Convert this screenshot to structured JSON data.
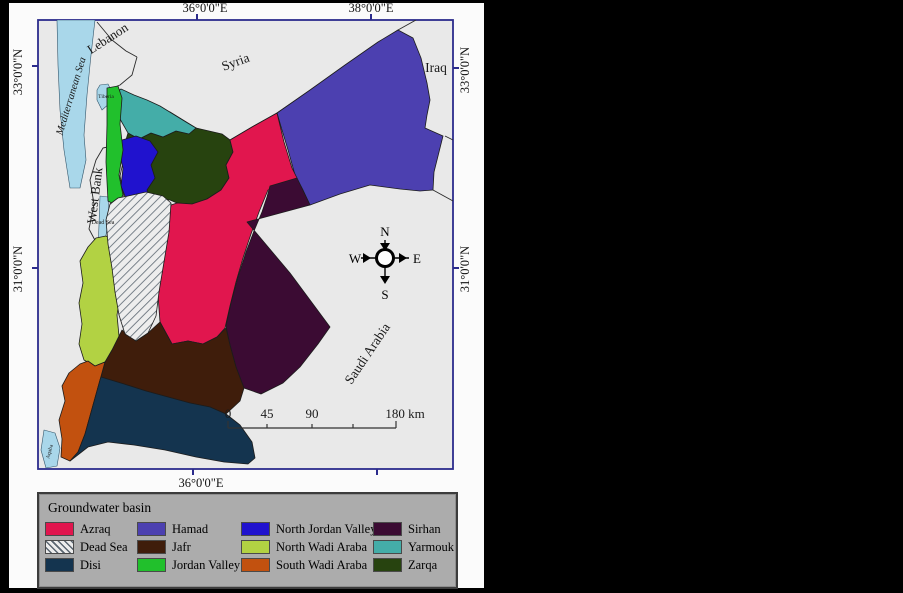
{
  "axis": {
    "top_36": "36°0'0\"E",
    "top_38": "38°0'0\"E",
    "bottom_36": "36°0'0\"E",
    "left_33": "33°0'0\"N",
    "left_31": "31°0'0\"N",
    "right_33": "33°0'0\"N",
    "right_31": "31°0'0\"N"
  },
  "places": {
    "mediterranean_sea": "Mediterranean Sea",
    "lebanon": "Lebanon",
    "syria": "Syria",
    "iraq": "Iraq",
    "west_bank": "West Bank",
    "saudi_arabia": "Saudi Arabia",
    "tiberia": "Tiberia",
    "dead_sea": "Dead Sea",
    "aqaba": "Aqaba"
  },
  "compass": {
    "n": "N",
    "e": "E",
    "s": "S",
    "w": "W"
  },
  "scale_bar": {
    "t0": "0",
    "t45": "45",
    "t90": "90",
    "t180": "180 km"
  },
  "map_colors": {
    "sea": "#a9d7ea",
    "land": "#e9e9e9",
    "frame": "#2b2b8c"
  },
  "legend": {
    "title": "Groundwater basin",
    "items": [
      {
        "label": "Azraq",
        "color": "#e1164e"
      },
      {
        "label": "Dead Sea",
        "color": "hatch"
      },
      {
        "label": "Disi",
        "color": "#14344f"
      },
      {
        "label": "Hamad",
        "color": "#4c40b0"
      },
      {
        "label": "Jafr",
        "color": "#3f1d0b"
      },
      {
        "label": "Jordan Valley",
        "color": "#21c02c"
      },
      {
        "label": "North Jordan Valley",
        "color": "#2012ce"
      },
      {
        "label": "North Wadi Araba",
        "color": "#b2d243"
      },
      {
        "label": "South Wadi Araba",
        "color": "#c2510f"
      },
      {
        "label": "Sirhan",
        "color": "#3b0b33"
      },
      {
        "label": "Yarmouk",
        "color": "#44ada8"
      },
      {
        "label": "Zarqa",
        "color": "#27430f"
      }
    ]
  }
}
